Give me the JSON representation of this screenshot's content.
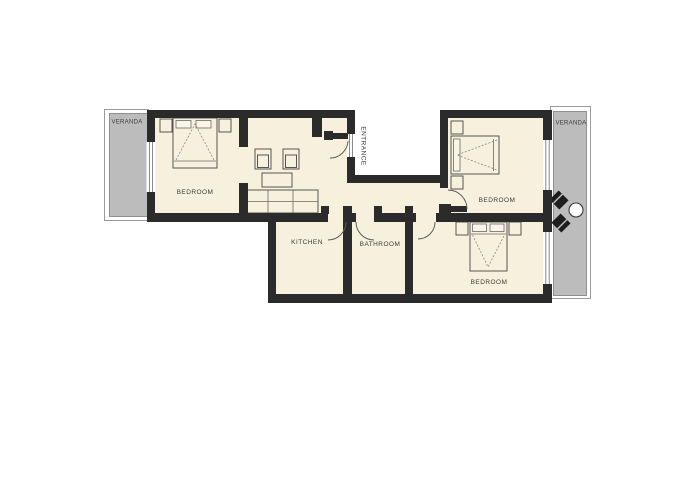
{
  "plan": {
    "rooms": {
      "bedroom_left": "BEDROOM",
      "bedroom_right_top": "BEDROOM",
      "bedroom_right_bottom": "BEDROOM",
      "kitchen": "KITCHEN",
      "bathroom": "BATHROOM",
      "entrance": "ENTRANCE",
      "veranda_left": "VERANDA",
      "veranda_right": "VERANDA"
    },
    "colors": {
      "wall": "#2b2b2b",
      "floor": "#f6f0dc",
      "veranda": "#bcbcbc",
      "background": "#ffffff"
    }
  }
}
